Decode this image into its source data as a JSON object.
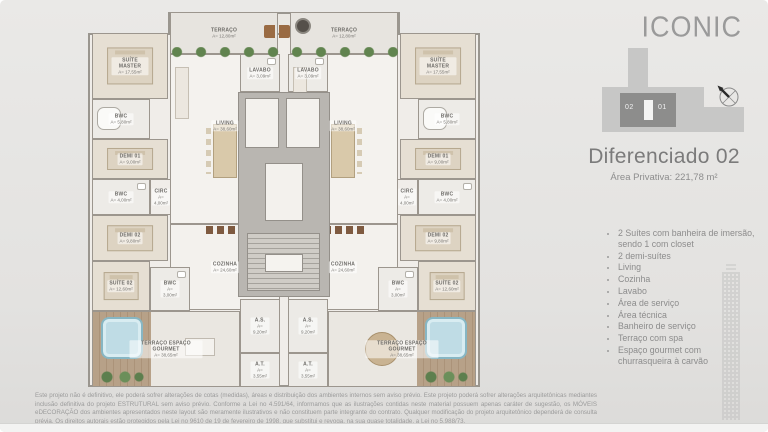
{
  "slide": {
    "logo": "ICONIC",
    "title": "Diferenciado 02",
    "subtitle": "Área Privativa: 221,78 m²",
    "keyplan": {
      "unit_left": "02",
      "unit_right": "01",
      "north": "N"
    },
    "features": [
      "2 Suítes com banheira de imersão, sendo 1 com closet",
      "2 demi-suítes",
      "Living",
      "Cozinha",
      "Lavabo",
      "Área de serviço",
      "Área técnica",
      "Banheiro de serviço",
      "Terraço com spa",
      "Espaço gourmet com churrasqueira à carvão"
    ],
    "disclaimer": "Este projeto não é definitivo, ele poderá sofrer alterações de cotas (medidas), áreas e distribuição dos ambientes internos sem aviso prévio. Este projeto poderá sofrer alterações arquitetônicas mediantes inclusão definitiva do projeto ESTRUTURAL sem aviso prévio. Conforme a Lei no 4.591/64, informamos que as ilustrações contidas neste material possuem apenas caráter de sugestão, os MÓVEIS eDECORAÇÃO dos ambientes apresentados neste layout são meramente ilustrativos e não constituem parte integrante do contrato. Qualquer modificação do projeto arquitetônico dependerá de consulta prévia. Os direitos autorais estão protegidos pela Lei no 9610 de 19 de fevereiro de 1998, que substitui e revoga, na sua quase totalidade, a Lei no 5.988/73."
  },
  "plan": {
    "rooms": [
      {
        "id": "terraco-esq",
        "name": "TERRAÇO",
        "area": "A= 12,80m²",
        "x": 82,
        "y": 0,
        "w": 108,
        "h": 42,
        "type": "terrace"
      },
      {
        "id": "terraco-dir",
        "name": "TERRAÇO",
        "area": "A= 12,80m²",
        "x": 202,
        "y": 0,
        "w": 108,
        "h": 42,
        "type": "terrace"
      },
      {
        "id": "suite-master-esq",
        "name": "SUÍTE MASTER",
        "area": "A= 17,55m²",
        "x": 4,
        "y": 21,
        "w": 76,
        "h": 66,
        "type": "bedroom",
        "furns": [
          "bed"
        ]
      },
      {
        "id": "suite-master-dir",
        "name": "SUÍTE MASTER",
        "area": "A= 17,55m²",
        "x": 312,
        "y": 21,
        "w": 76,
        "h": 66,
        "type": "bedroom",
        "furns": [
          "bed"
        ]
      },
      {
        "id": "bwc-master-esq",
        "name": "BWC",
        "area": "A= 5,80m²",
        "x": 4,
        "y": 87,
        "w": 58,
        "h": 40,
        "type": "bath",
        "furns": [
          "tub"
        ]
      },
      {
        "id": "bwc-master-dir",
        "name": "BWC",
        "area": "A= 5,80m²",
        "x": 330,
        "y": 87,
        "w": 58,
        "h": 40,
        "type": "bath",
        "furns": [
          "tub"
        ]
      },
      {
        "id": "demi01-esq",
        "name": "DEMI 01",
        "area": "A= 9,00m²",
        "x": 4,
        "y": 127,
        "w": 76,
        "h": 40,
        "type": "bedroom",
        "furns": [
          "bed"
        ]
      },
      {
        "id": "demi01-dir",
        "name": "DEMI 01",
        "area": "A= 9,00m²",
        "x": 312,
        "y": 127,
        "w": 76,
        "h": 40,
        "type": "bedroom",
        "furns": [
          "bed"
        ]
      },
      {
        "id": "bwc-demi-esq",
        "name": "BWC",
        "area": "A= 4,00m²",
        "x": 4,
        "y": 167,
        "w": 58,
        "h": 36,
        "type": "bath",
        "furns": [
          "sink"
        ]
      },
      {
        "id": "bwc-demi-dir",
        "name": "BWC",
        "area": "A= 4,00m²",
        "x": 330,
        "y": 167,
        "w": 58,
        "h": 36,
        "type": "bath",
        "furns": [
          "sink"
        ]
      },
      {
        "id": "circ-esq",
        "name": "CIRC",
        "area": "A= 4,00m²",
        "x": 62,
        "y": 167,
        "w": 22,
        "h": 36,
        "type": "hall"
      },
      {
        "id": "circ-dir",
        "name": "CIRC",
        "area": "A= 4,00m²",
        "x": 308,
        "y": 167,
        "w": 22,
        "h": 36,
        "type": "hall"
      },
      {
        "id": "demi02-esq",
        "name": "DEMI 02",
        "area": "A= 9,80m²",
        "x": 4,
        "y": 203,
        "w": 76,
        "h": 46,
        "type": "bedroom",
        "furns": [
          "bed"
        ]
      },
      {
        "id": "demi02-dir",
        "name": "DEMI 02",
        "area": "A= 9,80m²",
        "x": 312,
        "y": 203,
        "w": 76,
        "h": 46,
        "type": "bedroom",
        "furns": [
          "bed"
        ]
      },
      {
        "id": "living-esq",
        "name": "LIVING",
        "area": "A= 38,60m²",
        "x": 82,
        "y": 42,
        "w": 110,
        "h": 170,
        "type": "living",
        "furns": [
          "sofa",
          "dining"
        ]
      },
      {
        "id": "living-dir",
        "name": "LIVING",
        "area": "A= 38,60m²",
        "x": 200,
        "y": 42,
        "w": 110,
        "h": 170,
        "type": "living",
        "furns": [
          "sofa",
          "dining"
        ]
      },
      {
        "id": "lavabo-esq",
        "name": "LAVABO",
        "area": "A= 3,09m²",
        "x": 152,
        "y": 42,
        "w": 40,
        "h": 38,
        "type": "bath",
        "furns": [
          "sink"
        ]
      },
      {
        "id": "lavabo-dir",
        "name": "LAVABO",
        "area": "A= 3,09m²",
        "x": 200,
        "y": 42,
        "w": 40,
        "h": 38,
        "type": "bath",
        "furns": [
          "sink"
        ]
      },
      {
        "id": "cozinha-esq",
        "name": "COZINHA",
        "area": "A= 24,60m²",
        "x": 82,
        "y": 212,
        "w": 110,
        "h": 86,
        "type": "kitchen",
        "furns": [
          "stools"
        ]
      },
      {
        "id": "cozinha-dir",
        "name": "COZINHA",
        "area": "A= 24,60m²",
        "x": 200,
        "y": 212,
        "w": 110,
        "h": 86,
        "type": "kitchen",
        "furns": [
          "stools"
        ]
      },
      {
        "id": "suite02-esq",
        "name": "SUÍTE 02",
        "area": "A= 12,60m²",
        "x": 4,
        "y": 249,
        "w": 58,
        "h": 50,
        "type": "bedroom",
        "furns": [
          "bed"
        ]
      },
      {
        "id": "suite02-dir",
        "name": "SUÍTE 02",
        "area": "A= 12,60m²",
        "x": 330,
        "y": 249,
        "w": 58,
        "h": 50,
        "type": "bedroom",
        "furns": [
          "bed"
        ]
      },
      {
        "id": "bwc-servico-esq",
        "name": "BWC",
        "area": "A= 3,00m²",
        "x": 62,
        "y": 255,
        "w": 40,
        "h": 44,
        "type": "bath",
        "furns": [
          "sink"
        ]
      },
      {
        "id": "bwc-servico-dir",
        "name": "BWC",
        "area": "A= 3,00m²",
        "x": 290,
        "y": 255,
        "w": 40,
        "h": 44,
        "type": "bath",
        "furns": [
          "sink"
        ]
      },
      {
        "id": "as-esq",
        "name": "A.S.",
        "area": "A= 9,20m²",
        "x": 152,
        "y": 287,
        "w": 40,
        "h": 54,
        "type": "service"
      },
      {
        "id": "as-dir",
        "name": "A.S.",
        "area": "A= 9,20m²",
        "x": 200,
        "y": 287,
        "w": 40,
        "h": 54,
        "type": "service"
      },
      {
        "id": "at-esq",
        "name": "A.T.",
        "area": "A= 3,55m²",
        "x": 152,
        "y": 341,
        "w": 40,
        "h": 34,
        "type": "service"
      },
      {
        "id": "at-dir",
        "name": "A.T.",
        "area": "A= 3,55m²",
        "x": 200,
        "y": 341,
        "w": 40,
        "h": 34,
        "type": "service"
      },
      {
        "id": "gourmet-esq",
        "name": "TERRAÇO ESPAÇO GOURMET",
        "area": "A= 38,65m²",
        "x": 4,
        "y": 299,
        "w": 148,
        "h": 76,
        "type": "gourmet",
        "furns": [
          "deck-l",
          "spa-l",
          "plants-bl",
          "table-rect"
        ]
      },
      {
        "id": "gourmet-dir",
        "name": "TERRAÇO ESPAÇO GOURMET",
        "area": "A= 38,65m²",
        "x": 240,
        "y": 299,
        "w": 148,
        "h": 76,
        "type": "gourmet",
        "furns": [
          "deck-r",
          "spa-r",
          "plants-br",
          "table-round"
        ]
      }
    ]
  }
}
